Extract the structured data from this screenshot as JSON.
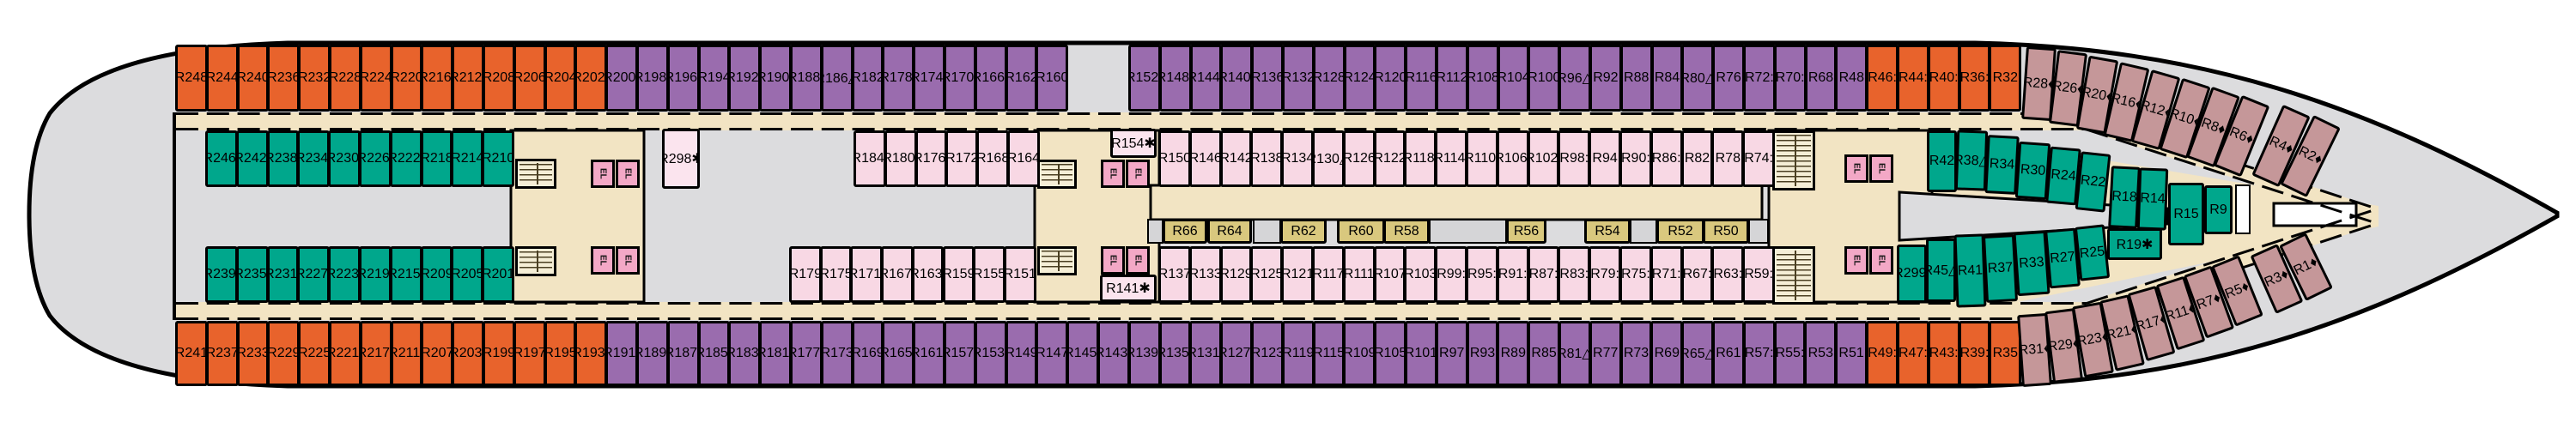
{
  "plan_type": "cruise-ship-deck-plan",
  "elevator_label": "EL",
  "symbols_seen": [
    "•",
    ":",
    "♦",
    "✱",
    "△"
  ],
  "palette": {
    "hull_gray": "#dcdcde",
    "corridor_beige": "#f2e4c3",
    "cabin_orange": "#e8632c",
    "cabin_purple": "#9a6cae",
    "cabin_teal": "#00a78c",
    "cabin_pink": "#f8d8e4",
    "cabin_pale_pink": "#fbe4ee",
    "cabin_mauve": "#c59799",
    "cabin_interior_yellow": "#d9c87e",
    "elevator_pink": "#f3a8c6",
    "stair_beige": "#f5eed6",
    "wall_black": "#000000"
  },
  "rows": {
    "top_outer": {
      "stern_orange": [
        "R248",
        "R244",
        "R240",
        "R236",
        "R232",
        "R228",
        "R224",
        "R220",
        "R216•",
        "R212•",
        "R208",
        "R206",
        "R204",
        "R202•"
      ],
      "mid_purple": [
        "R200•",
        "R198•",
        "R196•",
        "R194",
        "R192•",
        "R190•",
        "R188•",
        "R186△",
        "R182",
        "R178•",
        "R174•",
        "R170•",
        "R166•",
        "R162",
        "R160"
      ],
      "fwd_purple": [
        "R152•",
        "R148•",
        "R144•",
        "R140•",
        "R136",
        "R132",
        "R128",
        "R124",
        "R120",
        "R116",
        "R112",
        "R108",
        "R104",
        "R100",
        "R96△",
        "R92",
        "R88",
        "R84",
        "R80△",
        "R76",
        "R72:",
        "R70:",
        "R68",
        "R48"
      ],
      "fwd_orange": [
        "R46:",
        "R44:",
        "R40:",
        "R36:",
        "R32"
      ],
      "bow_mauve": [
        "R28♦",
        "R26♦",
        "R20♦",
        "R16♦",
        "R12♦",
        "R10♦",
        "R8♦",
        "R6♦",
        "R4♦",
        "R2♦"
      ]
    },
    "top_inner": {
      "stern_teal": [
        "R246:",
        "R242:",
        "R238:",
        "R234:",
        "R230:",
        "R226:",
        "R222:",
        "R218",
        "R214",
        "R210"
      ],
      "mid_pink": [
        "R184:",
        "R180:",
        "R176:",
        "R172",
        "R168",
        "R164"
      ],
      "fwd_pink": [
        "R150",
        "R146",
        "R142",
        "R138",
        "R134",
        "R130△",
        "R126",
        "R122",
        "R118:",
        "R114:",
        "R110:",
        "R106:",
        "R102:",
        "R98:",
        "R94",
        "R90:",
        "R86:",
        "R82",
        "R78",
        "R74:"
      ],
      "bow_teal": [
        "R42",
        "R38△",
        "R34",
        "R30",
        "R24",
        "R22",
        "R18",
        "R14"
      ]
    },
    "center_bow": [
      "R15",
      "R9"
    ],
    "middle_interior": [
      "R66",
      "R64",
      "R62",
      "R60",
      "R58",
      "R56",
      "R54",
      "R52",
      "R50"
    ],
    "bottom_inner": {
      "stern_teal": [
        "R239:",
        "R235:",
        "R231:",
        "R227:",
        "R223:",
        "R219:",
        "R215:",
        "R209",
        "R205",
        "R201"
      ],
      "mid_pink": [
        "R179",
        "R175",
        "R171:",
        "R167:",
        "R163:",
        "R159",
        "R155",
        "R151"
      ],
      "fwd_pink": [
        "R137",
        "R133",
        "R129",
        "R125",
        "R121",
        "R117",
        "R111",
        "R107",
        "R103",
        "R99:",
        "R95:",
        "R91:",
        "R87:",
        "R83:",
        "R79:",
        "R75:",
        "R71:",
        "R67:",
        "R63:",
        "R59:"
      ],
      "bow_teal": [
        "R299:",
        "R45△",
        "R41",
        "R37",
        "R33",
        "R27",
        "R25",
        "R19✱"
      ]
    },
    "bottom_outer": {
      "stern_orange": [
        "R241",
        "R237",
        "R233",
        "R229",
        "R225",
        "R221•",
        "R217•",
        "R211•",
        "R207",
        "R203•",
        "R199",
        "R197",
        "R195",
        "R193•"
      ],
      "mid_purple": [
        "R191•",
        "R189•",
        "R187•",
        "R185•",
        "R183•",
        "R181•",
        "R177•",
        "R173",
        "R169",
        "R165•",
        "R161•",
        "R157•",
        "R153•",
        "R149",
        "R147",
        "R145•",
        "R143•",
        "R139•",
        "R135•",
        "R131•",
        "R127•",
        "R123",
        "R119",
        "R115",
        "R109",
        "R105",
        "R101",
        "R97",
        "R93",
        "R89",
        "R85",
        "R81△",
        "R77",
        "R73",
        "R69",
        "R65△",
        "R61",
        "R57:",
        "R55:",
        "R53",
        "R51"
      ],
      "fwd_orange": [
        "R49:",
        "R47:",
        "R43:",
        "R39:",
        "R35"
      ],
      "bow_mauve": [
        "R31♦",
        "R29♦",
        "R23♦",
        "R21♦",
        "R17♦",
        "R11♦",
        "R7♦",
        "R5♦",
        "R3♦",
        "R1♦"
      ]
    },
    "specials": [
      "R298✱",
      "R154✱",
      "R141✱"
    ]
  }
}
